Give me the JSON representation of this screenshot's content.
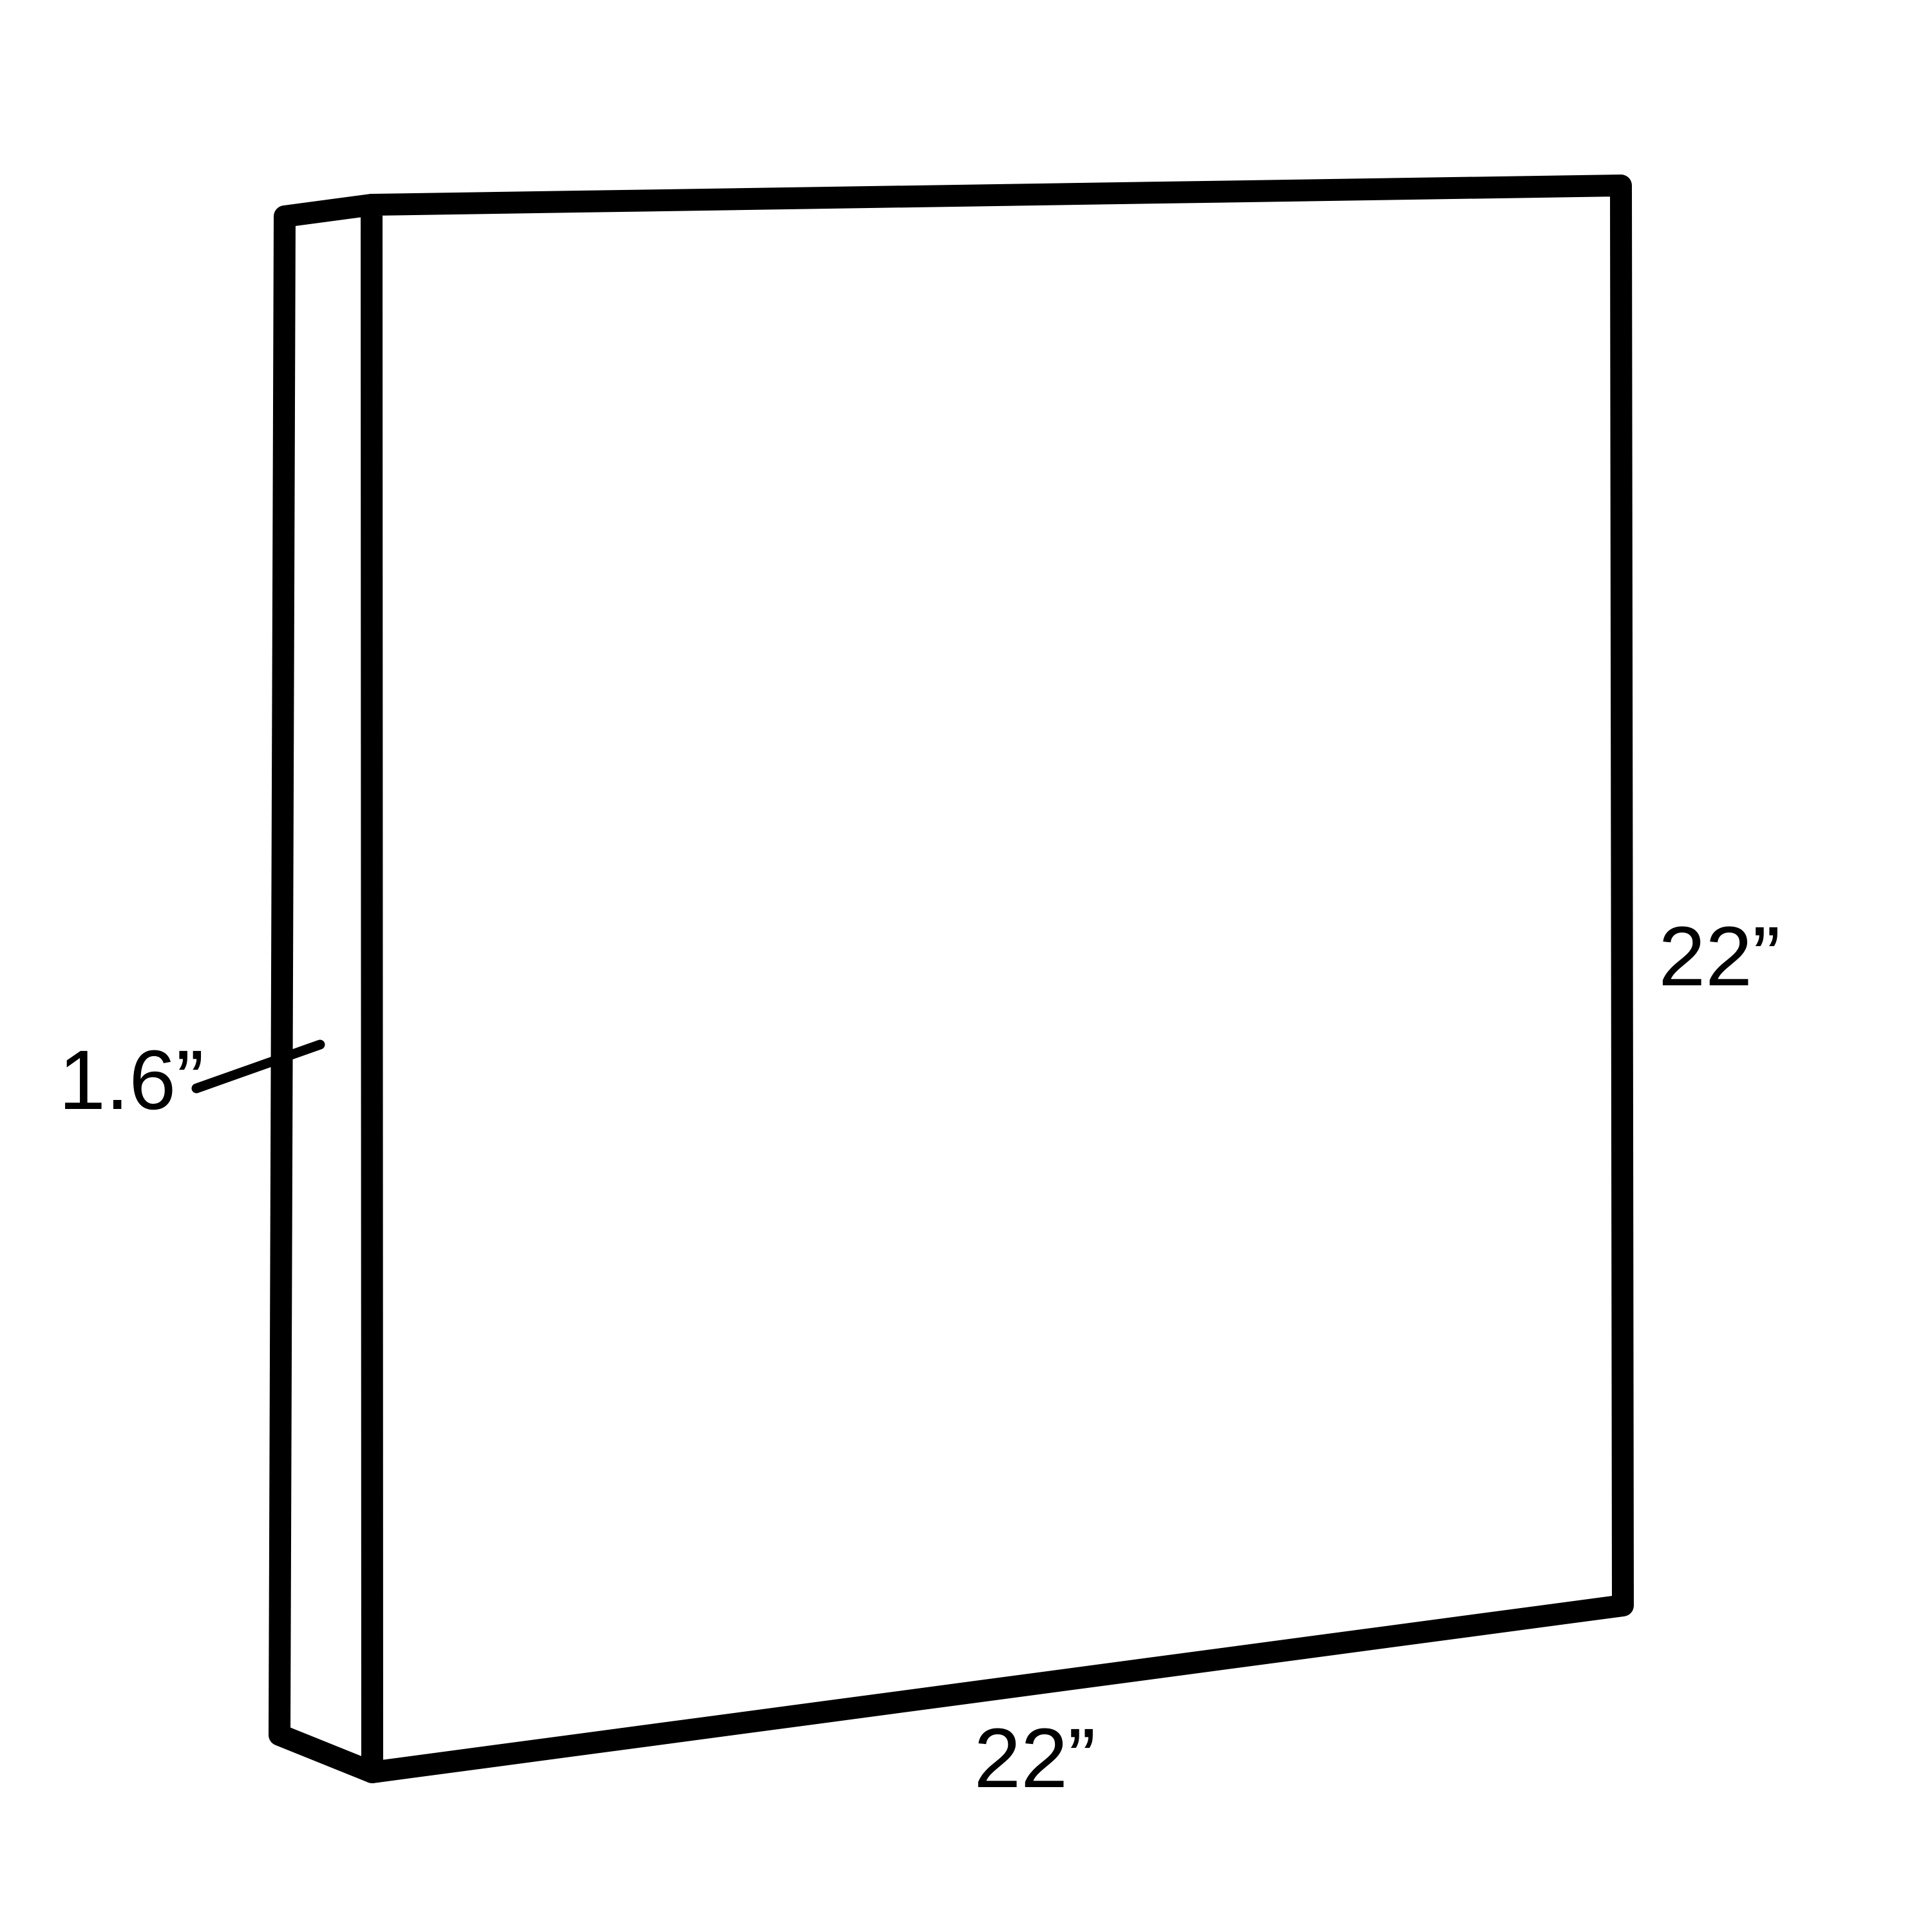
{
  "diagram": {
    "description": "Isometric-style line drawing of a rectangular panel with dimension callouts",
    "labels": {
      "depth": "1.6”",
      "height": "22”",
      "width": "22”"
    },
    "line_color": "#000000",
    "text_color": "#000000",
    "background_color": "#ffffff"
  }
}
